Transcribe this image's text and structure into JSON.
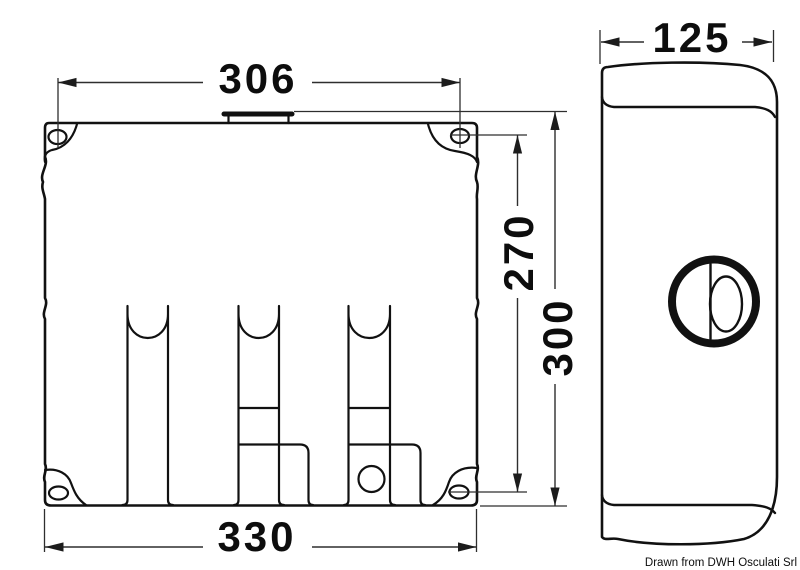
{
  "drawing": {
    "front_view": {
      "dim_width_top": "306",
      "dim_width_bottom": "330",
      "dim_height_holes": "270",
      "dim_height_total": "300"
    },
    "side_view": {
      "dim_depth": "125"
    },
    "credit": "Drawn from DWH Osculati Srl",
    "colors": {
      "background": "#ffffff",
      "line": "#111111",
      "dimension": "#2e2e2e",
      "text": "#0d0d0d"
    }
  }
}
